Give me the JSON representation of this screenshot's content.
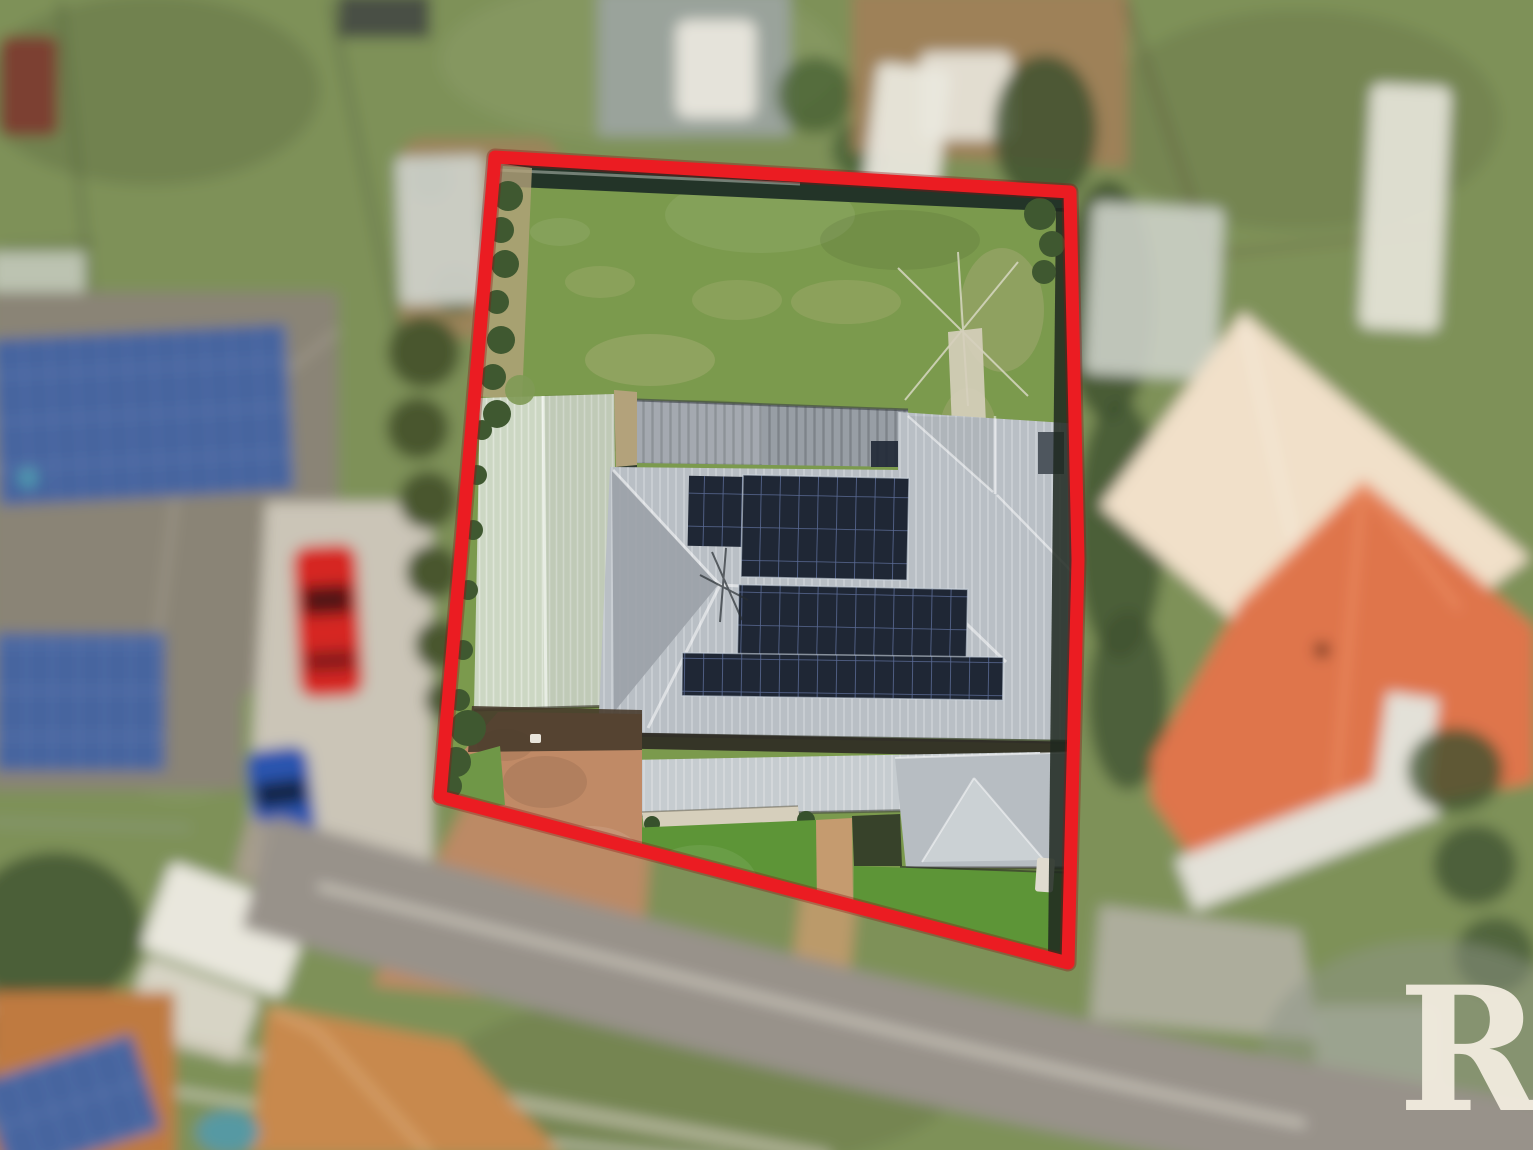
{
  "watermark": {
    "text": "R&"
  },
  "colors": {
    "boundary_red": "#eb1c22",
    "boundary_red_dark": "#8e0d12",
    "bg_grass": "#7e9158",
    "back_lawn": "#7b9a4d",
    "back_lawn_light": "#9aa768",
    "front_lawn": "#5d9537",
    "fence_dark": "#233428",
    "hedge_green": "#3f5830",
    "hedge_tan": "#b3a27b",
    "carport_roof": "#ccd7c3",
    "rear_roof": "#989ea5",
    "main_roof": "#b9bfc5",
    "veranda_roof": "#c6ccd0",
    "solar_dark": "#1f2735",
    "solar_grid": "#5a6a94",
    "driveway_tan": "#c08a66",
    "path_tan": "#c59b6f",
    "concrete_light": "#d6cfbc",
    "neighbor_left_roof": "#8a8476",
    "neighbor_solar": "#44639f",
    "neighbor_drive": "#cbc5b7",
    "car_red": "#d62824",
    "car_blue": "#2b55af",
    "conifer_green": "#48572e",
    "street_asphalt": "#98928a",
    "street_shoulder": "#a79d8b",
    "street_line": "#e8e4d6",
    "footpath": "#cfc9b8",
    "orange_roof": "#df754c",
    "orange_roof_ridge": "#ef9468",
    "cream_roof": "#f1e0c9",
    "orange_roof2": "#c8894e",
    "orange_roof3": "#bf7a40",
    "white_object": "#e9e7dd",
    "shed_gray": "#9aa39b",
    "shed_light": "#ccd0c8",
    "dirt_brown": "#a0815a",
    "pool_teal": "#4f9ab0",
    "boat_navy": "#2c3c55",
    "dark_roof": "#4a4f45",
    "red_shed": "#7c3a2c",
    "veg_dark": "#3f5230",
    "gray_roof_br": "#b9bdb9",
    "watermark_cream": "#f2ecdf"
  }
}
